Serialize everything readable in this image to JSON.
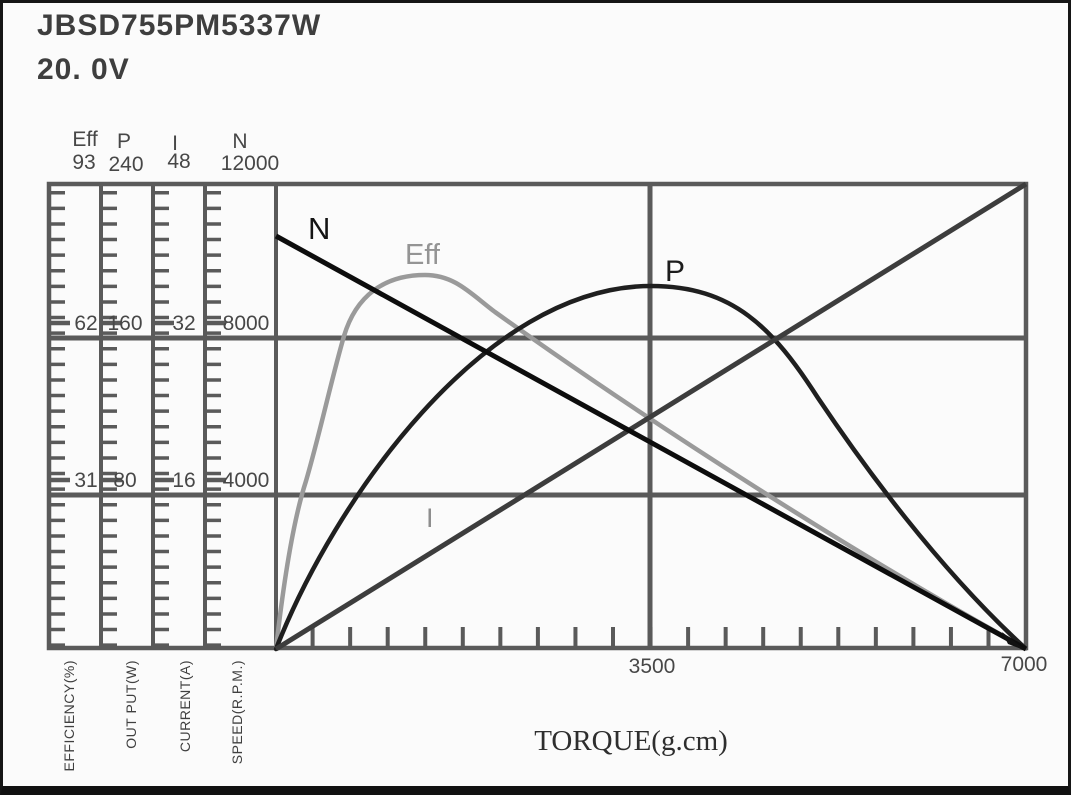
{
  "header": {
    "model": "JBSD755PM5337W",
    "voltage": "20. 0V"
  },
  "scales": {
    "eff": {
      "name": "Eff",
      "max": "93",
      "mid": "62",
      "low": "31",
      "axis_label": "EFFICIENCY(%)"
    },
    "p": {
      "name": "P",
      "max": "240",
      "mid": "160",
      "low": "80",
      "axis_label": "OUT PUT(W)"
    },
    "i": {
      "name": "I",
      "max": "48",
      "mid": "32",
      "low": "16",
      "axis_label": "CURRENT(A)"
    },
    "n": {
      "name": "N",
      "max": "12000",
      "mid": "8000",
      "low": "4000",
      "axis_label": "SPEED(R.P.M.)"
    }
  },
  "x_axis": {
    "label": "TORQUE(g.cm)",
    "mid_tick": "3500",
    "max_tick": "7000"
  },
  "curves": {
    "n": {
      "label": "N"
    },
    "eff": {
      "label": "Eff"
    },
    "p": {
      "label": "P"
    },
    "i": {
      "label": "I"
    }
  },
  "colors": {
    "grid": "#5a5a5a",
    "curve_n": "#0d0d0d",
    "curve_eff": "#9a9a9a",
    "curve_p": "#1f1f1f",
    "curve_i": "#3d3d3d",
    "text": "#474747"
  },
  "chart_data": {
    "type": "line",
    "title": "JBSD755PM5337W 20.0V motor performance curves",
    "xlabel": "TORQUE(g.cm)",
    "x_range": [
      0,
      7000
    ],
    "x_ticks_labeled": [
      3500,
      7000
    ],
    "grid": "on",
    "x": [
      0,
      500,
      1000,
      1500,
      2000,
      2500,
      3000,
      3500,
      4000,
      4500,
      5000,
      5500,
      6000,
      6500,
      7000
    ],
    "series": [
      {
        "name": "N",
        "unit": "SPEED(R.P.M.)",
        "axis_ticks": [
          4000,
          8000,
          12000
        ],
        "range": [
          0,
          12000
        ],
        "values": [
          10600,
          9840,
          9090,
          8330,
          7570,
          6810,
          6060,
          5300,
          4540,
          3790,
          3030,
          2270,
          1510,
          760,
          0
        ]
      },
      {
        "name": "Eff",
        "unit": "EFFICIENCY(%)",
        "axis_ticks": [
          31,
          62,
          93
        ],
        "range": [
          0,
          93
        ],
        "values": [
          0,
          52,
          69,
          74,
          70,
          63,
          56,
          49,
          42,
          35,
          28,
          21,
          15,
          8,
          0
        ]
      },
      {
        "name": "P",
        "unit": "OUT PUT(W)",
        "axis_ticks": [
          80,
          160,
          240
        ],
        "range": [
          0,
          240
        ],
        "values": [
          0,
          49,
          91,
          125,
          152,
          171,
          182,
          186,
          182,
          171,
          152,
          125,
          91,
          49,
          0
        ]
      },
      {
        "name": "I",
        "unit": "CURRENT(A)",
        "axis_ticks": [
          16,
          32,
          48
        ],
        "range": [
          0,
          48
        ],
        "values": [
          0,
          3.4,
          6.9,
          10.3,
          13.7,
          17.1,
          20.6,
          24,
          27.4,
          30.9,
          34.3,
          37.7,
          41.1,
          44.6,
          48
        ]
      }
    ],
    "annotations": {
      "max_efficiency_pct": 74,
      "max_efficiency_torque": 1400,
      "max_output_w": 186,
      "max_output_torque": 3500,
      "no_load_speed_rpm": 10600,
      "stall_current_a": 48
    }
  }
}
